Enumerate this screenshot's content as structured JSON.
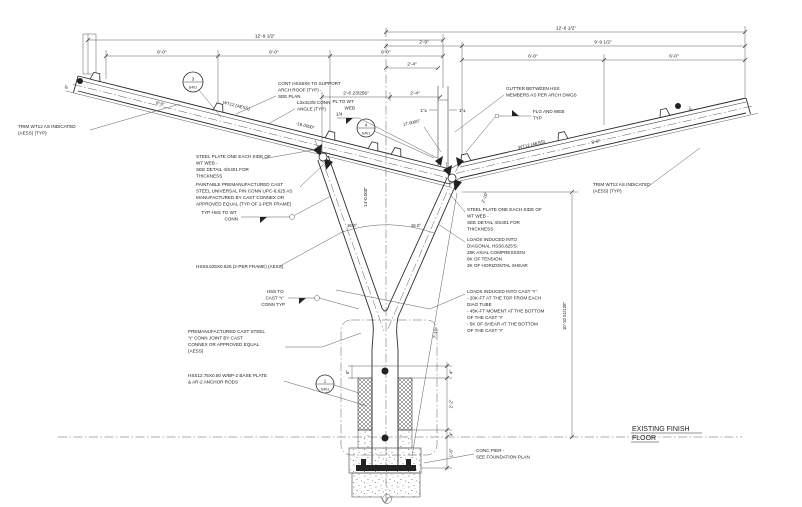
{
  "dims": {
    "left_total": "12'-9 1/2\"",
    "left_segments": [
      "6'-0\"",
      "6'-0\"",
      "6'-0\""
    ],
    "right_total": "12'-6 1/2\"",
    "right_a": "2'-9\"",
    "right_b": "9'-9 1/2\"",
    "right_segments": [
      "6'-0\"",
      "6'-0\""
    ],
    "ctr_upper": "2'-4\"",
    "ctr_lower_left": "2'-6 23/256\"",
    "ctr_lower_right": "2'-4\"",
    "gutter_left": "1\"±",
    "gutter_right": "1\"±",
    "left_beam_run": "8'-0\"",
    "right_beam_run": "8'-0\"",
    "left_end": "6\"",
    "right_end": "6\"",
    "angle_left_beam": "-16.0000°",
    "angle_right_beam": "17.0000°",
    "arc_left": "16.0°",
    "arc_right": "16.0°",
    "diag_axis": "14'-0.000\"",
    "node_offset": "2'-10\"",
    "y_height": "7'-10\"",
    "overall_height": "10'-10 51/128\"",
    "base_4_top": "4\"",
    "base_2_2": "2'-2\"",
    "base_4_bot": "4\"",
    "base_1_6": "1'-6\"",
    "bp_6": "6\""
  },
  "member_labels": {
    "wt12_left": "WT12 (AESS)",
    "wt12_right": "WT12 (AESS)"
  },
  "weld": {
    "size": "1/4"
  },
  "bubbles": {
    "detail_3": {
      "num": "3",
      "sheet": "S401"
    },
    "detail_4": {
      "num": "4",
      "sheet": "S401"
    },
    "detail_1": {
      "num": "1",
      "sheet": "S401"
    }
  },
  "notes": {
    "cont_hss": [
      "CONT HSS6X6 TO SUPPORT",
      "ARCH ROOF (TYP) -",
      "SEE PLAN"
    ],
    "conn_angle": [
      "L3x3x3/8 CONN",
      "ANGLE (TYP)"
    ],
    "pl_to_wt": [
      "PL TO WT",
      "WEB"
    ],
    "gutter": [
      "GUTTER BETWEEN HSS",
      "MEMBERS AS PER ARCH DWGS"
    ],
    "flg_web": [
      "FLG AND WEB",
      "TYP"
    ],
    "trim_left": [
      "TRIM WT12 AS INDICATED",
      "(AESS) (TYP)"
    ],
    "trim_right": [
      "TRIM WT12 AS INDICATED",
      "(AESS) (TYP)"
    ],
    "plate_left": [
      "STEEL PLATE ONE EACH SIDE OF",
      "WT WEB -",
      "SEE DETAIL 4/S401 FOR",
      "THICKNESS"
    ],
    "cast_pin": [
      "PAINTABLE PREMANUFACTURED CAST",
      "STEEL UNIVERSAL PIN CONN UPC-6.625 AS",
      "MANUFACTURED BY CAST CONNEX OR",
      "APPROVED EQUAL (TYP OF 2-PER FRAME)"
    ],
    "typ_hss_wt": [
      "TYP HSS TO WT",
      "CONN"
    ],
    "hss_diag": [
      "HSS6.625X0.625 (2-PER FRAME) (AESS)"
    ],
    "hss_cast": [
      "HSS TO",
      "CAST 'Y'",
      "CONN TYP"
    ],
    "cast_y": [
      "PREMANUFACTURED CAST STEEL",
      "'Y' CONN JOINT BY CAST",
      "CONNEX OR APPROVED EQUAL",
      "(AESS)"
    ],
    "base": [
      "HSS12.75X0.50 W/BP-2 BASE PLATE",
      "& AR-2 ANCHOR RODS"
    ],
    "plate_right": [
      "STEEL PLATE ONE EACH SIDE OF",
      "WT WEB -",
      "SEE DETAIL 4/S401 FOR",
      "THICKNESS"
    ],
    "loads_diag": [
      "LOADS INDUCED INTO",
      "DIAGONAL HSS6.625'S:",
      "28K AXIAL COMPRESSION",
      "6K OF TENSION",
      "3K OF HORIZONTAL SHEAR"
    ],
    "loads_cast": [
      "LOADS INDUCED INTO CAST 'Y':",
      "- 20K-FT AT THE TOP FROM EACH",
      "DIAG TUBE",
      "- 45K-FT MOMENT AT THE BOTTOM",
      "OF THE CAST 'Y'",
      "- 5K OF SHEAR AT THE BOTTOM",
      "OF THE CAST 'Y'"
    ],
    "conc_pier": [
      "CONC PIER -",
      "SEE FOUNDATION PLAN"
    ]
  },
  "floor": {
    "line1": "EXISTING FINISH",
    "line2": "FLOOR"
  }
}
